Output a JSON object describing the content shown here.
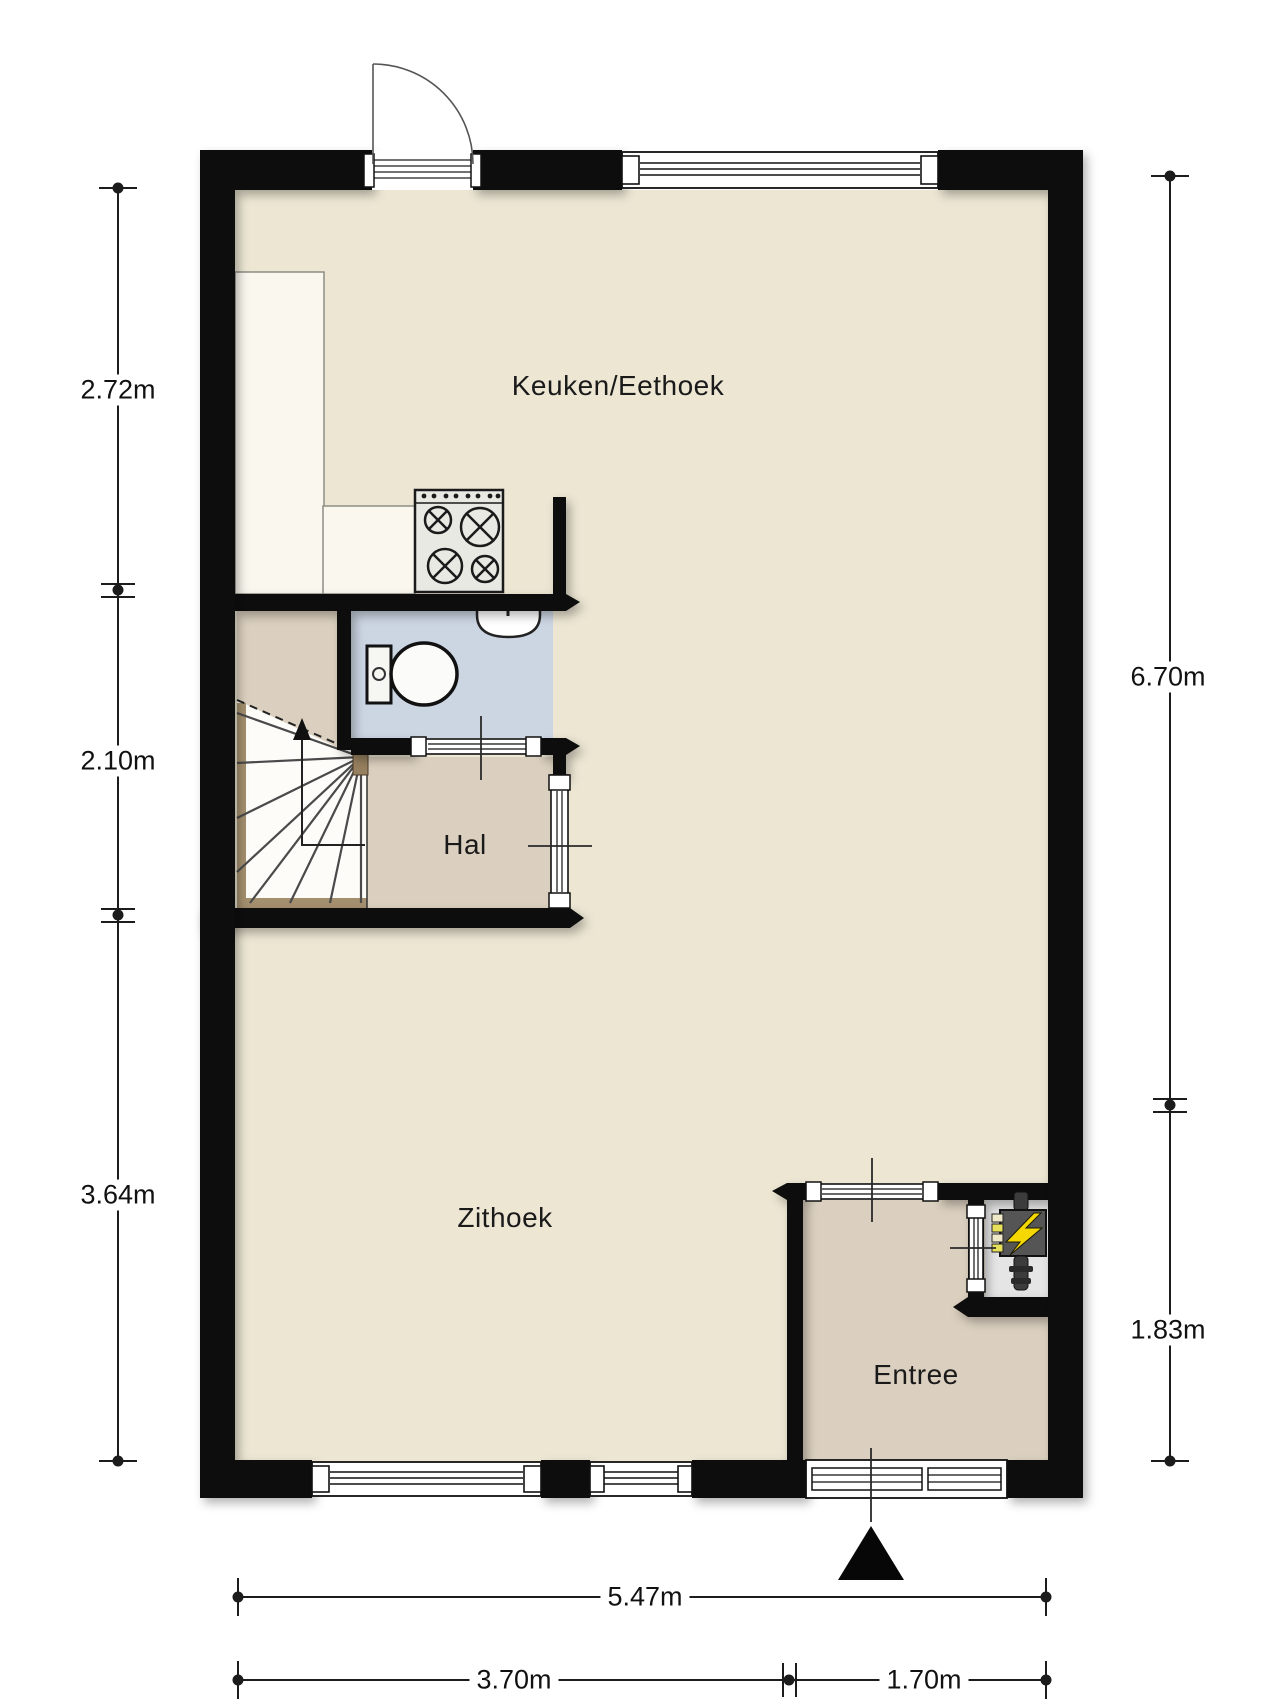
{
  "plan": {
    "type": "floor-plan",
    "rooms": [
      {
        "name": "Keuken/Eethoek"
      },
      {
        "name": "Hal"
      },
      {
        "name": "Zithoek"
      },
      {
        "name": "Entree"
      }
    ],
    "dimensions": {
      "left": [
        "2.72m",
        "2.10m",
        "3.64m"
      ],
      "right": [
        "6.70m",
        "1.83m"
      ],
      "bottom_total": "5.47m",
      "bottom_left": "3.70m",
      "bottom_right": "1.70m"
    },
    "icons": [
      "stove-icon",
      "toilet-icon",
      "sink-icon",
      "electrical-panel-icon",
      "stair-direction-arrow-icon",
      "entrance-marker-icon"
    ],
    "colors": {
      "wall": "#0f0f0f",
      "floor_main": "#ece6d3",
      "floor_hall": "#dbd0bf",
      "floor_toilet": "#ccd6e3",
      "meter_closet": "#e5e5e5",
      "counter": "#faf7ee",
      "lightning": "#f5d803",
      "wood_jamb": "#96805f"
    }
  }
}
